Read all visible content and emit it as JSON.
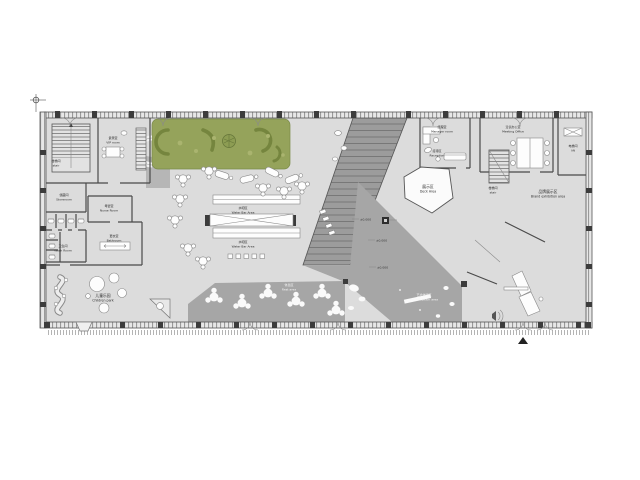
{
  "colors": {
    "floor": "#dcdcdc",
    "wall": "#3c3c3c",
    "green": "#95a35b",
    "green-dark": "#75853e",
    "platform": "#a6a6a6",
    "band": "#9c9c9c",
    "paper": "#ffffff"
  },
  "rooms": {
    "stair_left": {
      "zh": "楼梯间",
      "en": "stair"
    },
    "vip": {
      "zh": "贵宾室",
      "en": "VIP room"
    },
    "storeroom": {
      "zh": "储藏间",
      "en": "Storeroom"
    },
    "nurse": {
      "zh": "母婴室",
      "en": "Nurse Room"
    },
    "washroom": {
      "zh": "卫生间",
      "en": "Wash Room"
    },
    "bathroom": {
      "zh": "更衣室",
      "en": "Bathroom"
    },
    "children": {
      "zh": "儿童乐园",
      "en": "Children park"
    },
    "water_bar": {
      "zh": "水吧区",
      "en": "Water Bar Area"
    },
    "deck": {
      "zh": "展示区",
      "en": "Deck Area"
    },
    "manager": {
      "zh": "经理室",
      "en": "Manager room"
    },
    "meeting": {
      "zh": "洽谈办公室",
      "en": "Meeting Office"
    },
    "lift": {
      "zh": "电梯间",
      "en": "lift"
    },
    "stair_right": {
      "zh": "楼梯间",
      "en": "stair"
    },
    "brand": {
      "zh": "品牌展示区",
      "en": "Brand exhibition area"
    },
    "rest": {
      "zh": "休息区",
      "en": "Rest area"
    },
    "art": {
      "zh": "艺术体验区",
      "en": "Art exhibition area"
    },
    "reception": {
      "zh": "接待区",
      "en": "Reception"
    }
  },
  "markers": {
    "value": "±0.000"
  }
}
